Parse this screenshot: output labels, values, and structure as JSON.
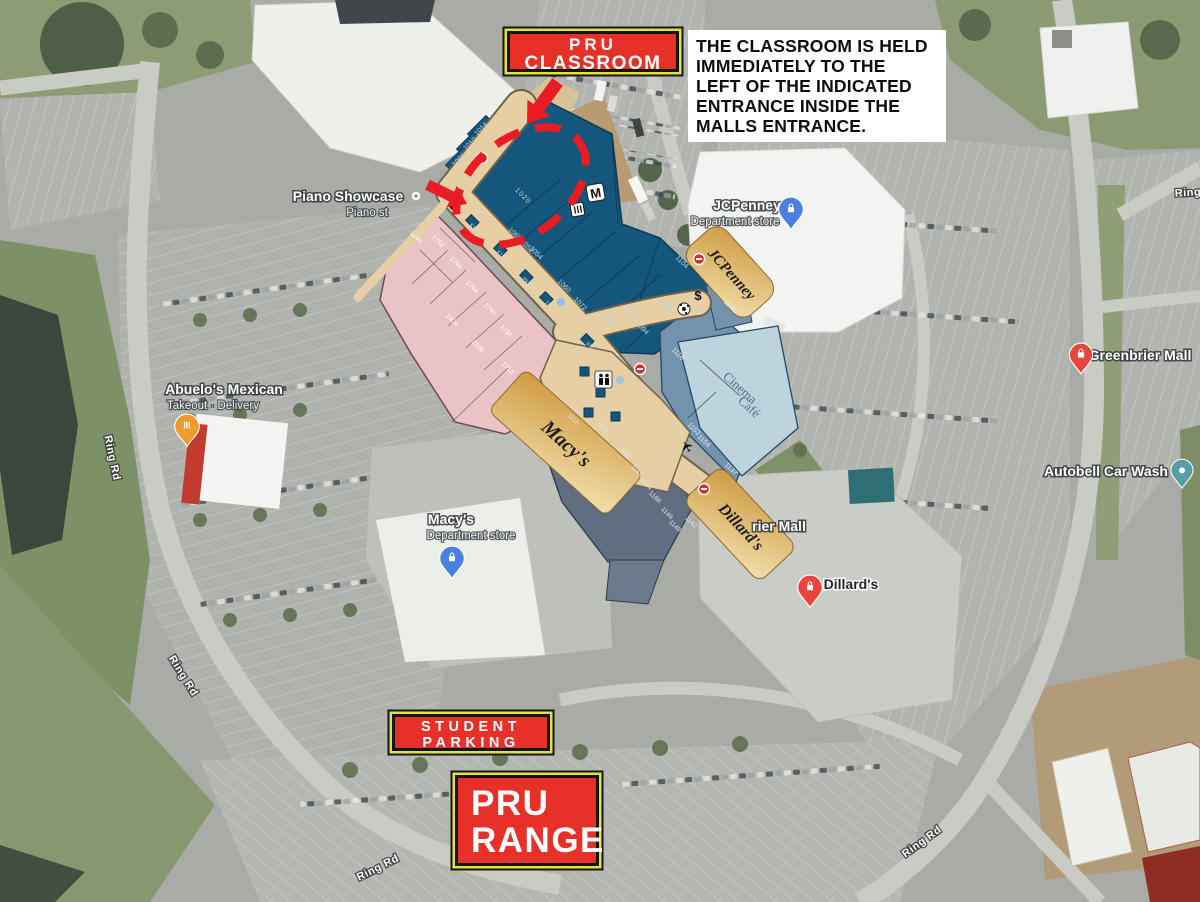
{
  "annotations": {
    "pru_classroom_line1": "PRU",
    "pru_classroom_line2": "CLASSROOM",
    "note_text": "THE CLASSROOM IS HELD\nIMMEDIATELY TO THE\nLEFT OF THE INDICATED\nENTRANCE INSIDE THE\nMALLS ENTRANCE.",
    "student_parking_line1": "STUDENT",
    "student_parking_line2": "PARKING",
    "pru_range_line1": "PRU",
    "pru_range_line2": "RANGE",
    "colors": {
      "banner_red": "#e63028",
      "banner_yellow": "#e3e23a",
      "banner_black": "#141414",
      "arrow_red": "#ea1c23",
      "note_bg": "#ffffff",
      "floorplan_navy": "#15567c",
      "floorplan_pink": "#e9c3c6",
      "floorplan_tan": "#e6cfa4"
    }
  },
  "pois": {
    "piano": {
      "name": "Piano Showcase",
      "sub": "Piano st"
    },
    "abuelos": {
      "name": "Abuelo's Mexican",
      "sub": "Takeout · Delivery"
    },
    "jcpenney": {
      "name": "JCPenney",
      "sub": "Department store"
    },
    "macys": {
      "name": "Macy's",
      "sub": "Department store"
    },
    "dillards": {
      "name": "Dillard's"
    },
    "greenbrier": {
      "name": "Greenbrier Mall"
    },
    "greenbrier_partial": "rier Mall",
    "autobell": {
      "name": "Autobell Car Wash"
    }
  },
  "roads": {
    "ring_rd": "Ring Rd",
    "ring_partial": "Ring"
  },
  "floorplan": {
    "anchors": {
      "jcpenney": "JCPenney",
      "macys": "Macy's",
      "dillards": "Dillard's",
      "cinema_line1": "Cinema",
      "cinema_line2": "Café"
    },
    "icons": {
      "m_logo": "M",
      "dollar": "$",
      "plane": "✈"
    },
    "units": {
      "u1014": "1014",
      "u1010": "1010",
      "u1006": "1006",
      "u1020": "1020",
      "u1068": "1068 1052",
      "u1054": "1054",
      "u1060": "1060",
      "u1072": "1072",
      "u1090": "1090",
      "u1096": "1096",
      "u1094": "1094",
      "u1104": "1104",
      "u1096a": "1096A",
      "u1106": "1106",
      "u1116": "1116",
      "u1137": "1137",
      "u1152": "1152",
      "u1154": "1154",
      "u1156": "1156",
      "u1160": "1160",
      "u1162": "1162",
      "u1164": "1164",
      "u1166": "1166",
      "u1168": "1168",
      "u1146": "1146",
      "u1148": "1148",
      "u1142": "1142",
      "k106": "K106",
      "k120": "K120",
      "pk123": "PK123",
      "k113": "113",
      "k107": "107",
      "p1240": "1240",
      "p1752": "1752",
      "p1748": "1748",
      "p1744": "1744",
      "p1740": "1740",
      "p1730": "1730",
      "p2104": "2104",
      "p2108": "2108",
      "p1712": "1712"
    }
  }
}
